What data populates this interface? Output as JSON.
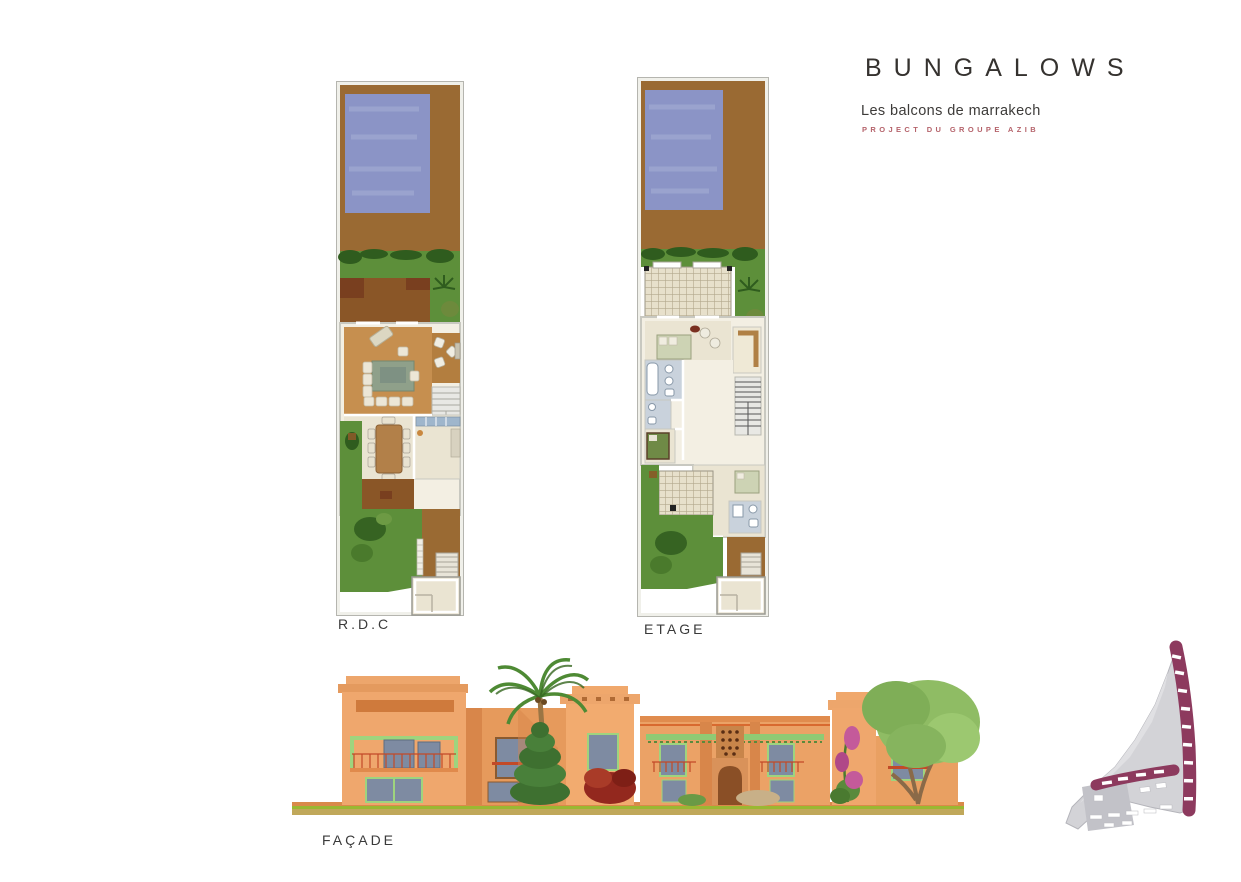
{
  "header": {
    "title": "BUNGALOWS",
    "subtitle": "Les balcons de marrakech",
    "tagline": "PROJECT DU GROUPE AZIB"
  },
  "labels": {
    "rdc": "R.D.C",
    "etage": "ETAGE",
    "facade": "FAÇADE"
  },
  "plans": [
    {
      "id": "rdc",
      "label": "R.D.C",
      "type": "floor-plan",
      "features": [
        "pool",
        "deck",
        "garden",
        "terrace",
        "living-room",
        "sitting-nook",
        "stairs",
        "dining-room",
        "kitchen",
        "entrance"
      ]
    },
    {
      "id": "etage",
      "label": "ETAGE",
      "type": "floor-plan",
      "features": [
        "pool",
        "deck",
        "garden",
        "pergola",
        "bedrooms",
        "bathrooms",
        "balcony",
        "stairs",
        "entrance"
      ]
    },
    {
      "id": "facade",
      "label": "FAÇADE",
      "type": "elevation",
      "features": [
        "two-story-terracotta-buildings",
        "balconies",
        "arched-door",
        "palm-tree",
        "trees",
        "shrubs"
      ]
    },
    {
      "id": "site-plan",
      "label": "",
      "type": "key-map",
      "features": [
        "highlighted-bungalow-plots"
      ]
    }
  ],
  "palette": {
    "ink": "#35322f",
    "accent_red": "#b5636b",
    "deck_brown": "#9a6a33",
    "terrace_brown": "#8a5627",
    "dark_patio": "#793f1f",
    "pool_blue": "#8b94c6",
    "pool_light": "#a7aed6",
    "garden_green": "#5d8f3a",
    "garden_dark": "#2f5c1e",
    "wood_floor": "#c68f4f",
    "wood_dark": "#b37e3f",
    "room_beige": "#eae4d2",
    "room_light": "#f3efe3",
    "tile_blue": "#c9d2dc",
    "wall_gray": "#c8c8c0",
    "frame_gray": "#b5b5af",
    "stair_gray": "#e8e8e4",
    "facade_orange": "#efa76d",
    "facade_mid": "#e69a5c",
    "facade_shadow": "#d8864a",
    "facade_deep": "#cf7a3c",
    "window_blue": "#7e8ba2",
    "window_frame": "#5f6c80",
    "trim_green": "#9ed47e",
    "awning_green": "#8fca74",
    "rail_red": "#c24a28",
    "door_brown": "#8a4f26",
    "palm_green": "#4e8a34",
    "tree_dark": "#3e7030",
    "tree_mid": "#49803a",
    "tree_light": "#8fbc64",
    "tree_pale": "#9cc870",
    "bush_red": "#93281e",
    "bougainvillea_pink": "#c45a9a",
    "ground_olive": "#c0a85a",
    "ground_line": "#9ab832",
    "site_gray": "#d3d3d7",
    "site_gray_dark": "#c2c2c8",
    "site_maroon": "#8d3a5e"
  }
}
